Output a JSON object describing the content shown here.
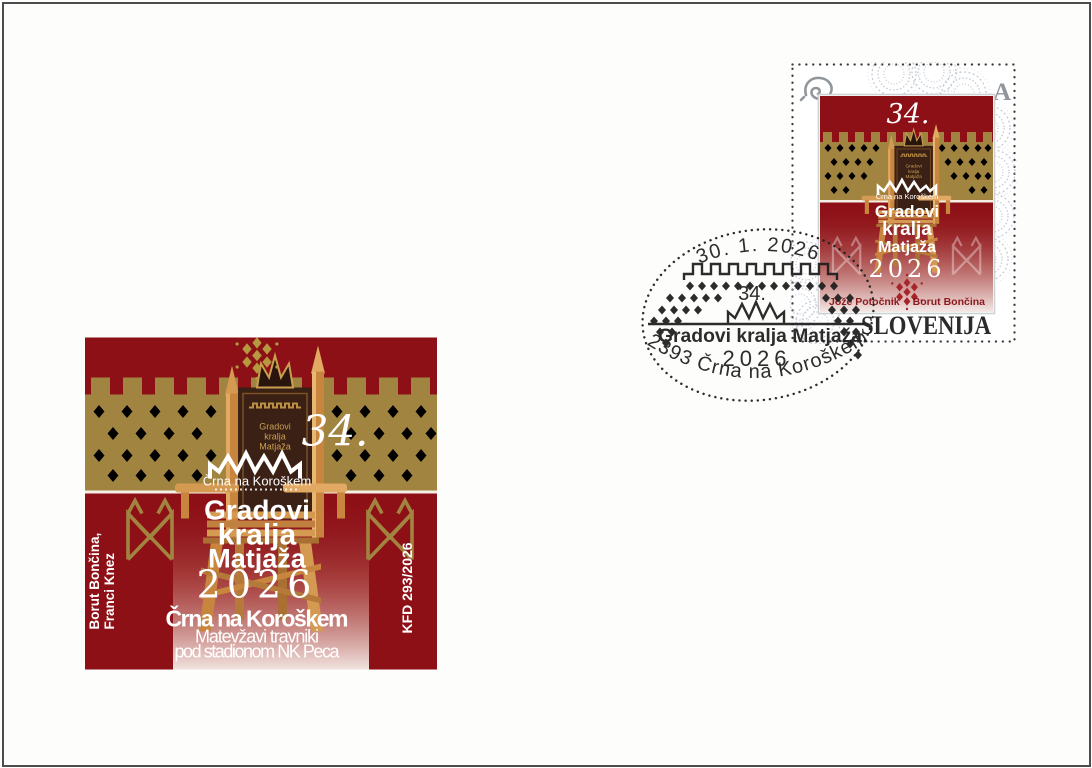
{
  "cachet": {
    "number": "34.",
    "location_small": "Črna na Koroškem",
    "title_lines": [
      "Gradovi",
      "kralja",
      "Matjaža"
    ],
    "year": "2026",
    "location_bold": "Črna na Koroškem",
    "subtitle_lines": [
      "Matevžavi travniki",
      "pod stadionom NK Peca"
    ],
    "authors_vertical": [
      "Borut Bončina,",
      "Franci Knez"
    ],
    "edition_vertical": "KFD 293/2026",
    "backrest_text_lines": [
      "Gradovi",
      "kralja",
      "Matjaža"
    ]
  },
  "stamp": {
    "letter_mark": "A",
    "posthorn_icon": "post-horn",
    "number": "34.",
    "location_small": "Črna na Koroškem",
    "title_lines": [
      "Gradovi",
      "kralja",
      "Matjaža"
    ],
    "year": "2026",
    "author_left": "Jože Potočnik",
    "author_right": "Borut Bončina",
    "country": "SLOVENIJA"
  },
  "postmark": {
    "date": "30. 1. 2026",
    "number": "34.",
    "title": "Gradovi kralja Matjaža",
    "year": "2026",
    "post_office": "2393 Črna na Koroškem"
  },
  "colors": {
    "cachet_red": "#8d1016",
    "band_gold": "#a28441",
    "diamond_ivory": "#efe8da",
    "wood_light": "#e2a964",
    "wood_mid": "#c8853e",
    "backrest_brown": "#3b2015",
    "crown_gold": "#c9a050",
    "names_dark_red": "#8c1a1f",
    "snowflake_red": "#a8232a",
    "country_ink": "#2b2b2b",
    "postmark_ink": "#1f1f1f",
    "lace_gray": "#b2bbc5",
    "mark_gray": "#90969b"
  }
}
